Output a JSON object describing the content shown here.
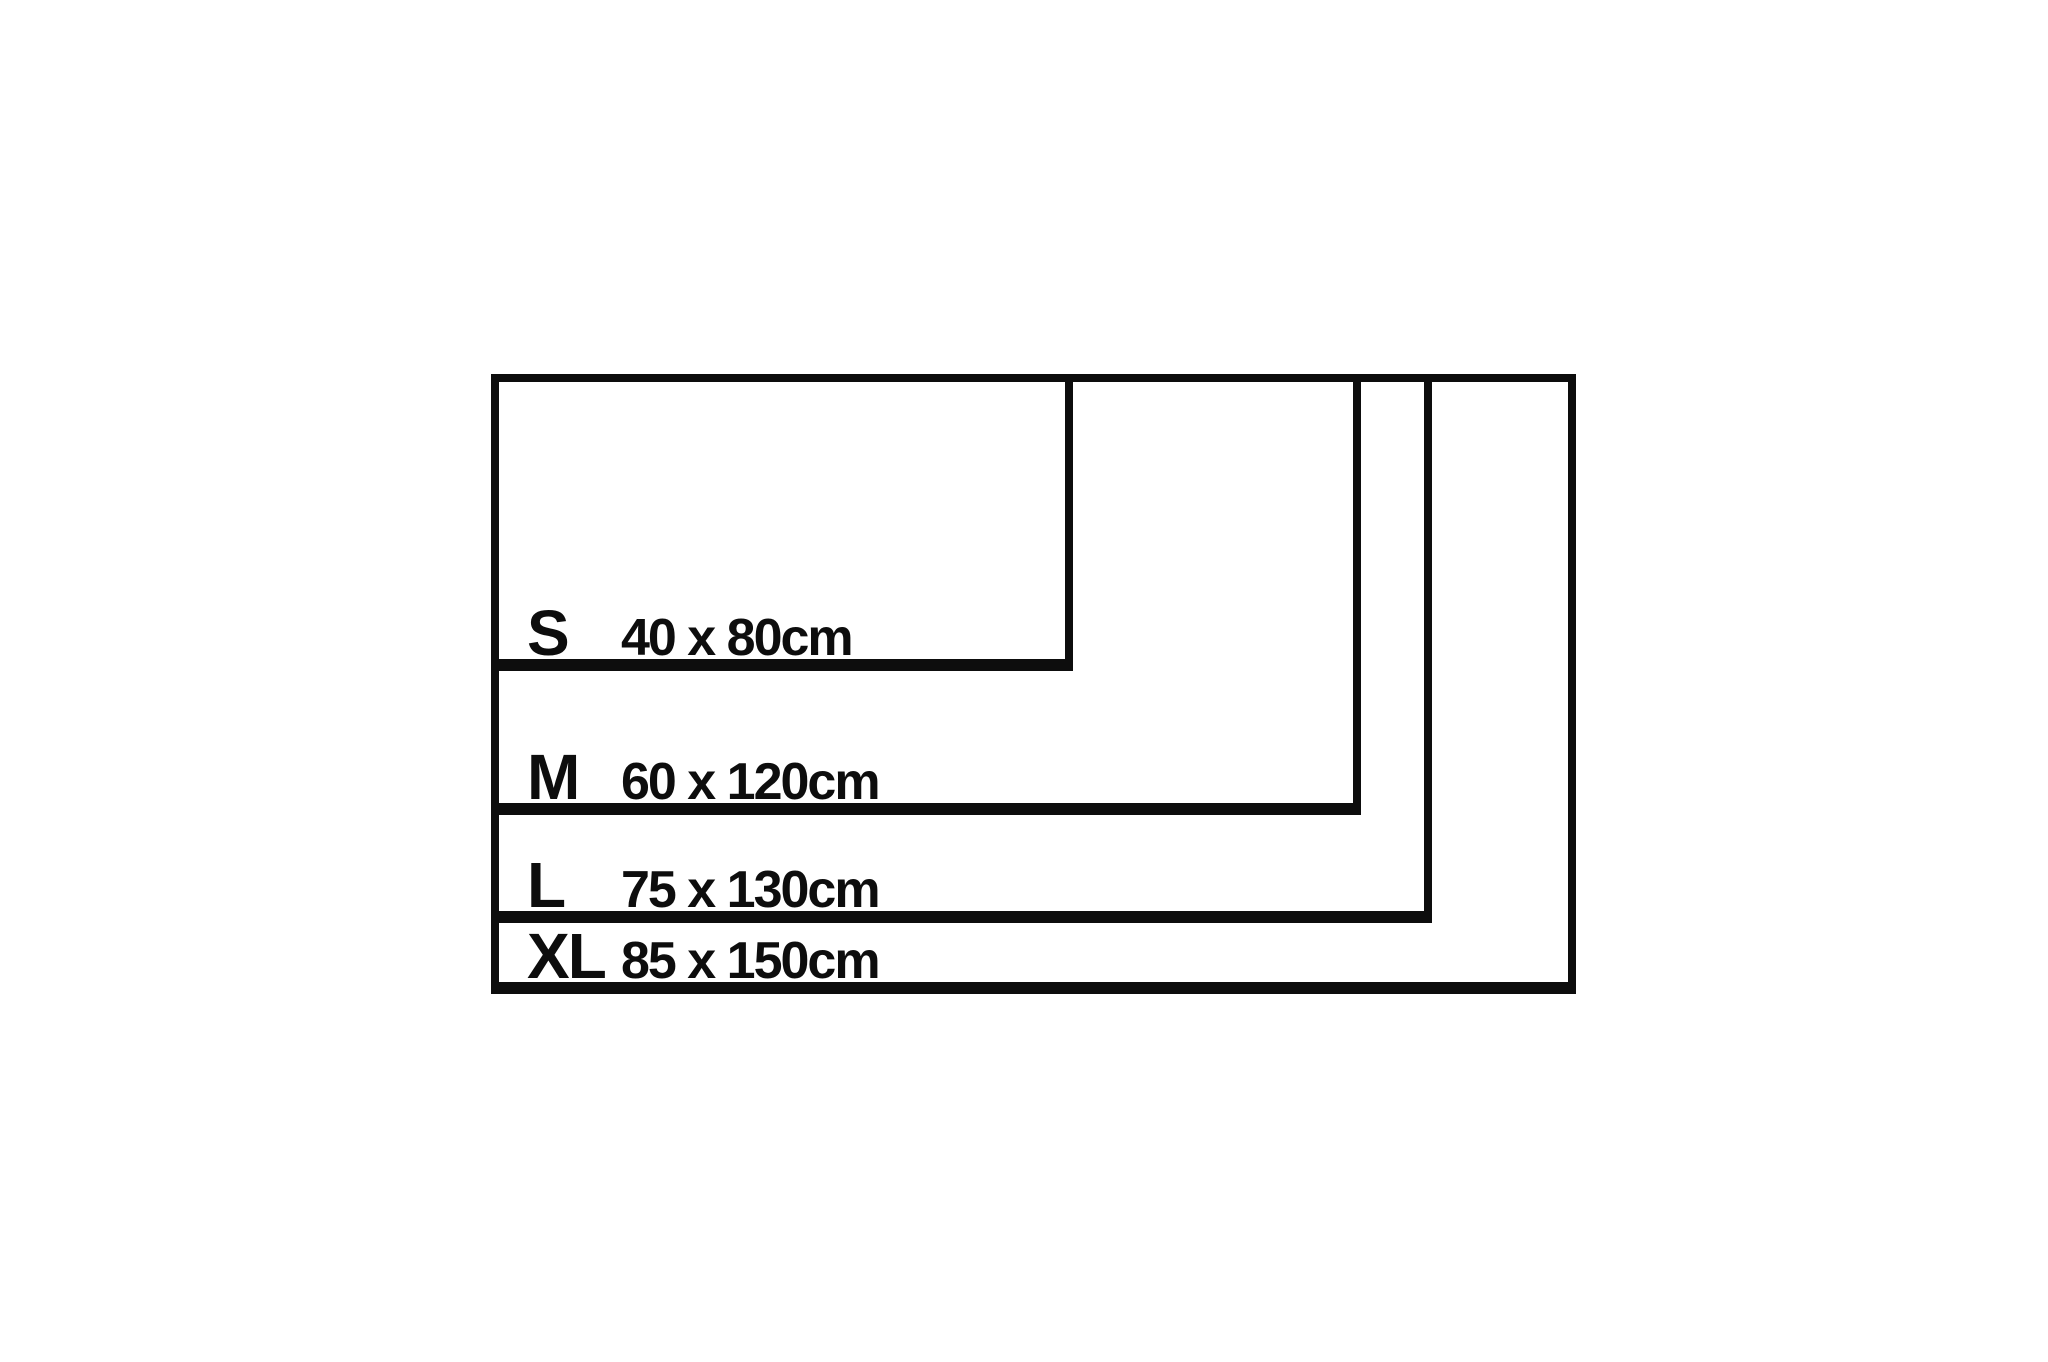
{
  "diagram": {
    "kind": "nested-size-chart",
    "unit": "cm",
    "colors": {
      "line": "#0d0d0d",
      "text": "#0d0d0d",
      "background": "#ffffff"
    },
    "sizes": [
      {
        "label": "S",
        "dimensions": "40 x 80cm",
        "width_cm": 80,
        "height_cm": 40
      },
      {
        "label": "M",
        "dimensions": "60 x 120cm",
        "width_cm": 120,
        "height_cm": 60
      },
      {
        "label": "L",
        "dimensions": "75 x 130cm",
        "width_cm": 130,
        "height_cm": 75
      },
      {
        "label": "XL",
        "dimensions": "85 x 150cm",
        "width_cm": 150,
        "height_cm": 85
      }
    ]
  }
}
